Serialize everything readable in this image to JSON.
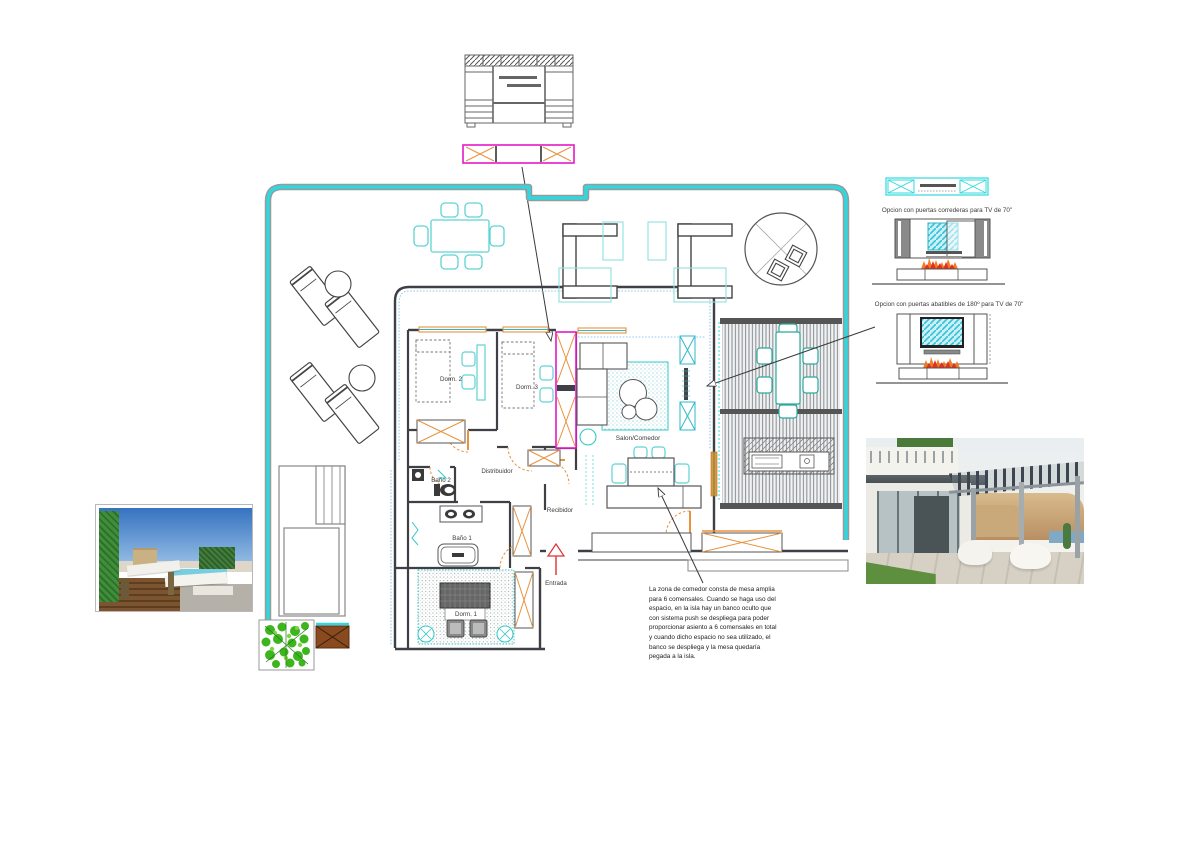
{
  "sheet": {
    "background": "#ffffff"
  },
  "colors": {
    "boundary_cyan": "#2fd8de",
    "furniture_cyan": "#5fd3d3",
    "orange": "#e8923d",
    "magenta": "#e318c8",
    "wall_gray": "#3f3f46",
    "entry_red": "#e03030",
    "plant_green": "#3db51e"
  },
  "plan": {
    "rooms": {
      "dorm2": "Dorm. 2",
      "dorm3": "Dorm. 3",
      "salon": "Salon/Comedor",
      "distribuidor": "Distribuidor",
      "bano2": "Baño 2",
      "bano1": "Baño 1",
      "recibidor": "Recibidor",
      "dorm1": "Dorm. 1",
      "entrada": "Entrada"
    }
  },
  "annotations": {
    "tv_option_1": "Opcion con puertas correderas para TV de 70\"",
    "tv_option_2": "Opcion con puertas abatibles de 180º para TV de 70\"",
    "dining_note": "La zona de comedor consta de mesa amplia para 6 comensales. Cuando se haga uso del espacio, en la isla hay un banco oculto que con sistema push se despliega para poder proporcionar asiento a 6 comensales en total y cuando dicho espacio no sea utilizado, el banco se despliega y la mesa quedaría pegada a la isla."
  }
}
